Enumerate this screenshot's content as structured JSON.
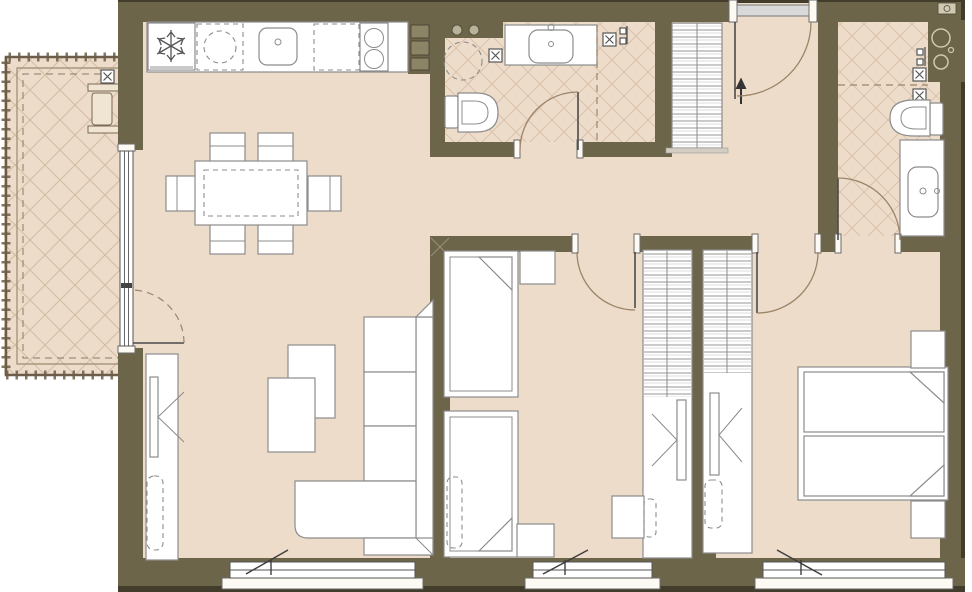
{
  "meta": {
    "title": "apartment-floor-plan",
    "description": "Floor plan of a two-bedroom apartment with open kitchen/living-dining area, two bathrooms, hallway and balcony"
  },
  "colors": {
    "wall": "#6d654a",
    "wall-edge": "#423c2b",
    "wall-inner": "#8d8465",
    "floor": "#eedcca",
    "hatch": "#d9c3ac",
    "hatch2": "#d2bca4",
    "outline": "#8c8c8c",
    "door-arc": "#9b8468",
    "frame": "#555555",
    "sill": "#fdfaf4",
    "slab": "#d9d9d9",
    "symbol": "#555555",
    "rail": "#6b5d49"
  },
  "rooms": [
    {
      "name": "balcony",
      "features": [
        "railing",
        "planter-unit",
        "cross-hatched floor"
      ]
    },
    {
      "name": "kitchen-living-dining",
      "features": [
        "kitchen counter",
        "fridge (snowflake-icon)",
        "sink",
        "2-burner cooktop",
        "dishwasher space (dashed)",
        "dining table with 6 chairs",
        "corner sofa",
        "2 coffee tables",
        "tv cabinet with tv"
      ]
    },
    {
      "name": "bathroom-1",
      "features": [
        "washing-machine space (dashed circle)",
        "toilet",
        "vanity with sink",
        "shower zone (dashed divider)",
        "floor drains",
        "service shaft"
      ]
    },
    {
      "name": "hallway",
      "features": [
        "entrance door with swing arc and arrow",
        "striped wardrobe"
      ]
    },
    {
      "name": "bedroom-1",
      "features": [
        "two single beds with folded blankets",
        "two nightstands",
        "wardrobe column with tv panel",
        "desk with chair"
      ]
    },
    {
      "name": "bedroom-2",
      "features": [
        "double bed with two mattresses",
        "two nightstands",
        "wardrobe column with tv panel",
        "stool (dashed)"
      ]
    },
    {
      "name": "bathroom-2",
      "features": [
        "shower zone (dashed divider)",
        "shower-head",
        "floor drains",
        "toilet",
        "vanity with sink",
        "service shaft with pipes"
      ]
    }
  ],
  "openings": [
    "entrance-door-top",
    "balcony-glass-door-left",
    "living-room-window-bottom",
    "bedroom-1-window-bottom",
    "bedroom-2-window-bottom"
  ],
  "icons": [
    "snowflake-fridge-icon",
    "floor-drain-icon",
    "shower-head-icon",
    "entrance-arrow-icon",
    "burner-icon",
    "faucet-dot-icon"
  ]
}
